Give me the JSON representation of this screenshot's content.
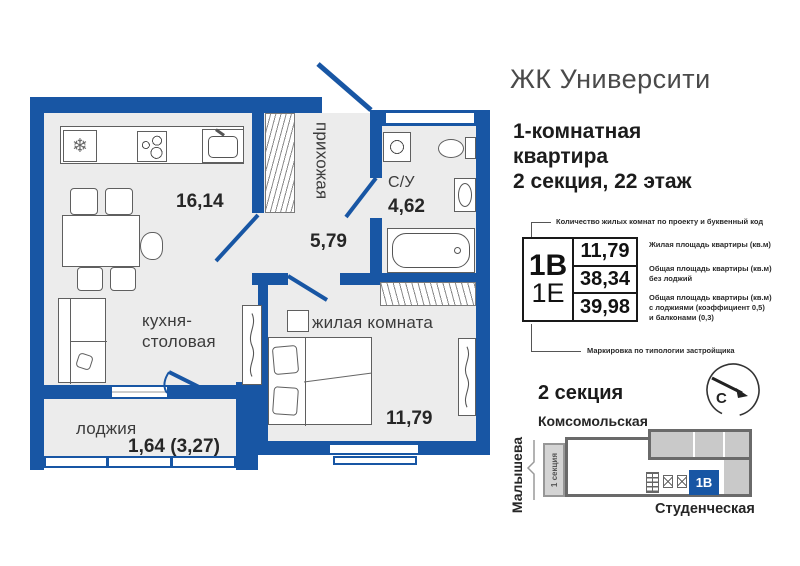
{
  "header": {
    "brand": "ЖК Университи",
    "apartment_title": "1-комнатная\nквартира\n2 секция, 22 этаж"
  },
  "plan": {
    "kitchen": {
      "name": "кухня-\nстоловая",
      "area": "16,14"
    },
    "hallway": {
      "name": "прихожая",
      "area": "5,79"
    },
    "bathroom": {
      "name": "С/У",
      "area": "4,62"
    },
    "living": {
      "name": "жилая комната",
      "area": "11,79"
    },
    "loggia": {
      "name": "лоджия",
      "area": "1,64 (3,27)"
    }
  },
  "legend": {
    "top_note": "Количество жилых комнат по проекту и буквенный код",
    "code_main": "1В",
    "code_alt": "1Е",
    "rows": [
      {
        "value": "11,79",
        "label": "Жилая площадь квартиры (кв.м)"
      },
      {
        "value": "38,34",
        "label": "Общая площадь квартиры (кв.м)\nбез лоджий"
      },
      {
        "value": "39,98",
        "label": "Общая площадь квартиры (кв.м)\nс лоджиями (коэффициент 0,5)\nи балконами (0,3)"
      }
    ],
    "bottom_note": "Маркировка по типологии застройщика"
  },
  "site_map": {
    "title": "2 секция",
    "street_top": "Комсомольская",
    "street_left": "Малышева",
    "street_bottom": "Студенческая",
    "section_strip": "1 секция",
    "unit_code": "1В",
    "compass_north": "С"
  },
  "colors": {
    "wall_blue": "#1856a4",
    "floor_gray": "#ececec",
    "map_unit_blue": "#1856a4",
    "map_gray": "#c9c9c9",
    "map_outline": "#6a6a6a"
  }
}
